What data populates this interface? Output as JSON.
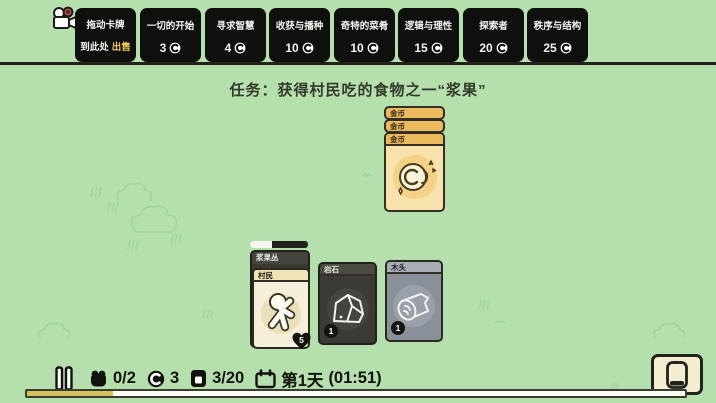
{
  "colors": {
    "background": "#b6dfae",
    "pack_box": "#0f0f0d",
    "sell_highlight": "#f0c94f",
    "gold_card_header": "#eaba5c",
    "gold_card_body": "#f8e2ab",
    "dark_card": "#3b3b35",
    "wood_card": "#8b919a",
    "day_fill": "#d3c35e"
  },
  "top_bar": {
    "sell_box": {
      "line1": "拖动卡牌",
      "line2_prefix": "到此处",
      "line2_highlight": "出售"
    },
    "packs": [
      {
        "name": "一切的开始",
        "price": "3"
      },
      {
        "name": "寻求智慧",
        "price": "4"
      },
      {
        "name": "收获与播种",
        "price": "10"
      },
      {
        "name": "奇特的菜肴",
        "price": "10"
      },
      {
        "name": "逻辑与理性",
        "price": "15"
      },
      {
        "name": "探索者",
        "price": "20"
      },
      {
        "name": "秩序与结构",
        "price": "25"
      }
    ]
  },
  "task": {
    "text": "任务：获得村民吃的食物之一“浆果”"
  },
  "board": {
    "coin_stack": {
      "titles": [
        "金币",
        "金币",
        "金币"
      ]
    },
    "berry_stack": {
      "bottom_title": "浆果丛",
      "top_title": "村民",
      "health": "5",
      "harvest_progress_pct": 38
    },
    "rock_card": {
      "title": "岩石",
      "count": "1"
    },
    "wood_card": {
      "title": "木头",
      "count": "1"
    }
  },
  "hud": {
    "villagers": "0/2",
    "coins": "3",
    "cards": "3/20",
    "day": "第1天",
    "time": "(01:51)",
    "day_progress_pct": 13
  }
}
